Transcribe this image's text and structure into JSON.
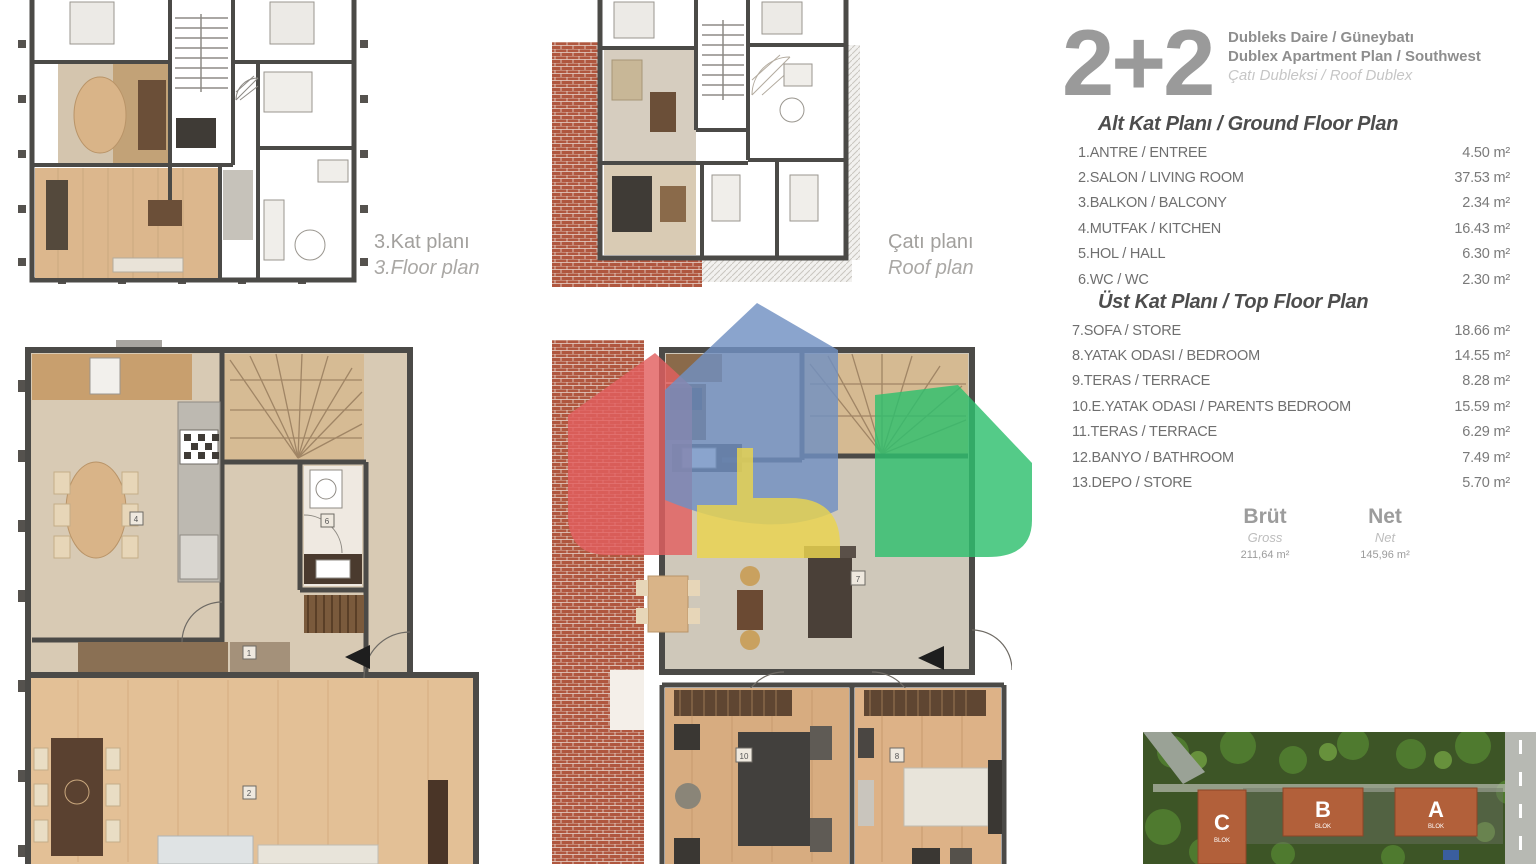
{
  "header": {
    "type_code": "2+2",
    "line1": "Dubleks Daire / Güneybatı",
    "line2": "Dublex Apartment Plan / Southwest",
    "line3": "Çatı Dubleksi / Roof Dublex"
  },
  "ground_floor": {
    "title": "Alt Kat Planı / Ground Floor Plan",
    "rooms": [
      {
        "label": "1.ANTRE / ENTREE",
        "area": "4.50 m²"
      },
      {
        "label": "2.SALON / LIVING ROOM",
        "area": "37.53 m²"
      },
      {
        "label": "3.BALKON / BALCONY",
        "area": "2.34 m²"
      },
      {
        "label": "4.MUTFAK / KITCHEN",
        "area": "16.43 m²"
      },
      {
        "label": "5.HOL / HALL",
        "area": "6.30 m²"
      },
      {
        "label": "6.WC / WC",
        "area": "2.30 m²"
      }
    ]
  },
  "top_floor": {
    "title": "Üst Kat Planı / Top Floor Plan",
    "rooms": [
      {
        "label": "7.SOFA / STORE",
        "area": "18.66 m²"
      },
      {
        "label": "8.YATAK ODASI / BEDROOM",
        "area": "14.55 m²"
      },
      {
        "label": "9.TERAS / TERRACE",
        "area": "8.28 m²"
      },
      {
        "label": "10.E.YATAK ODASI / PARENTS BEDROOM",
        "area": "15.59 m²"
      },
      {
        "label": "11.TERAS / TERRACE",
        "area": "6.29 m²"
      },
      {
        "label": "12.BANYO / BATHROOM",
        "area": "7.49 m²"
      },
      {
        "label": "13.DEPO / STORE",
        "area": "5.70 m²"
      }
    ]
  },
  "totals": {
    "brut_label": "Brüt",
    "brut_sub": "Gross",
    "brut_value": "211,64 m²",
    "net_label": "Net",
    "net_sub": "Net",
    "net_value": "145,96 m²"
  },
  "captions": {
    "third_floor_tr": "3.Kat planı",
    "third_floor_en": "3.Floor plan",
    "roof_tr": "Çatı planı",
    "roof_en": "Roof plan"
  },
  "markers": {
    "lower": [
      "4",
      "6",
      "1",
      "2"
    ],
    "upper": [
      "7",
      "10",
      "8"
    ]
  },
  "site": {
    "blocks": [
      "C",
      "B",
      "A"
    ],
    "blok_label": "BLOK"
  },
  "logo_colors": {
    "blue": "#7090c2",
    "red": "#e25f5f",
    "green": "#2ebf6e",
    "yellow": "#ead44d"
  }
}
